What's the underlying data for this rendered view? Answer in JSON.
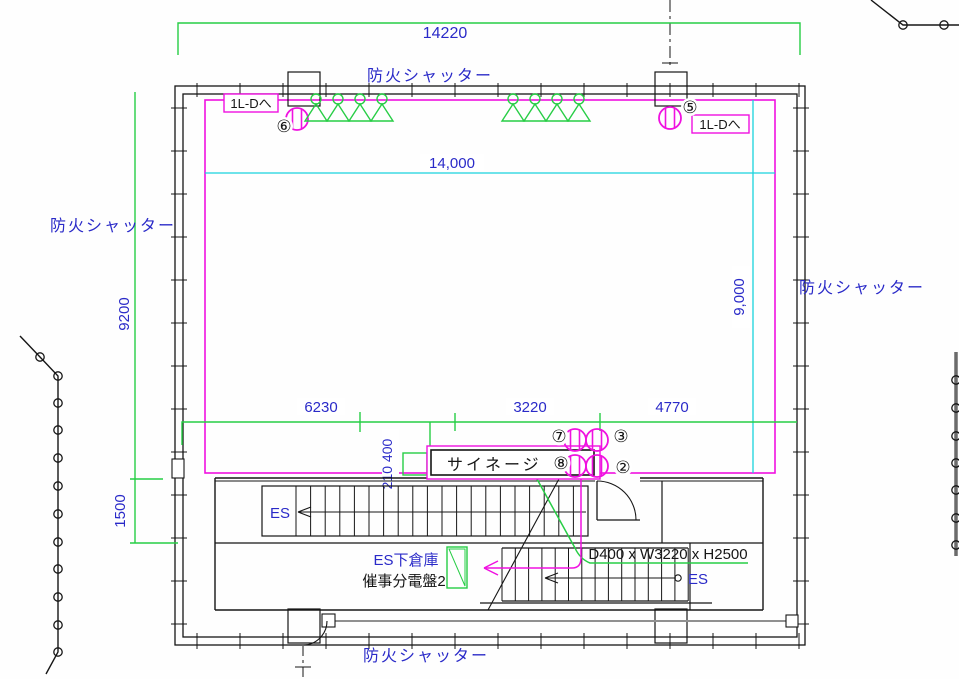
{
  "labels": {
    "fire_shutter": "防火シャッター",
    "to_1l_d": "1L-Dへ",
    "signage": "サイネージ",
    "signage_size": "D400 x W3220 x H2500",
    "escalator": "ES",
    "es_under_storage": "ES下倉庫",
    "event_panel": "催事分電盤2"
  },
  "dimensions": {
    "overall_width": "14220",
    "inner_width": "14,000",
    "inner_depth": "9,000",
    "depth_main": "9200",
    "depth_lower": "1500",
    "span_left": "6230",
    "span_center": "3220",
    "span_right": "4770",
    "signage_offset": "210 400"
  },
  "callouts": {
    "no2": "②",
    "no3": "③",
    "no5": "⑤",
    "no6": "⑥",
    "no7": "⑦",
    "no8": "⑧"
  },
  "colors": {
    "dimension_text": "#2a2ac8",
    "annotation": "#161616",
    "hatch": "#f011e0",
    "grid": "#19d3dd",
    "dimension_line": "#27cd45",
    "wall": "#262626",
    "handrail": "#6b6b6b",
    "gray_line": "#909090"
  }
}
